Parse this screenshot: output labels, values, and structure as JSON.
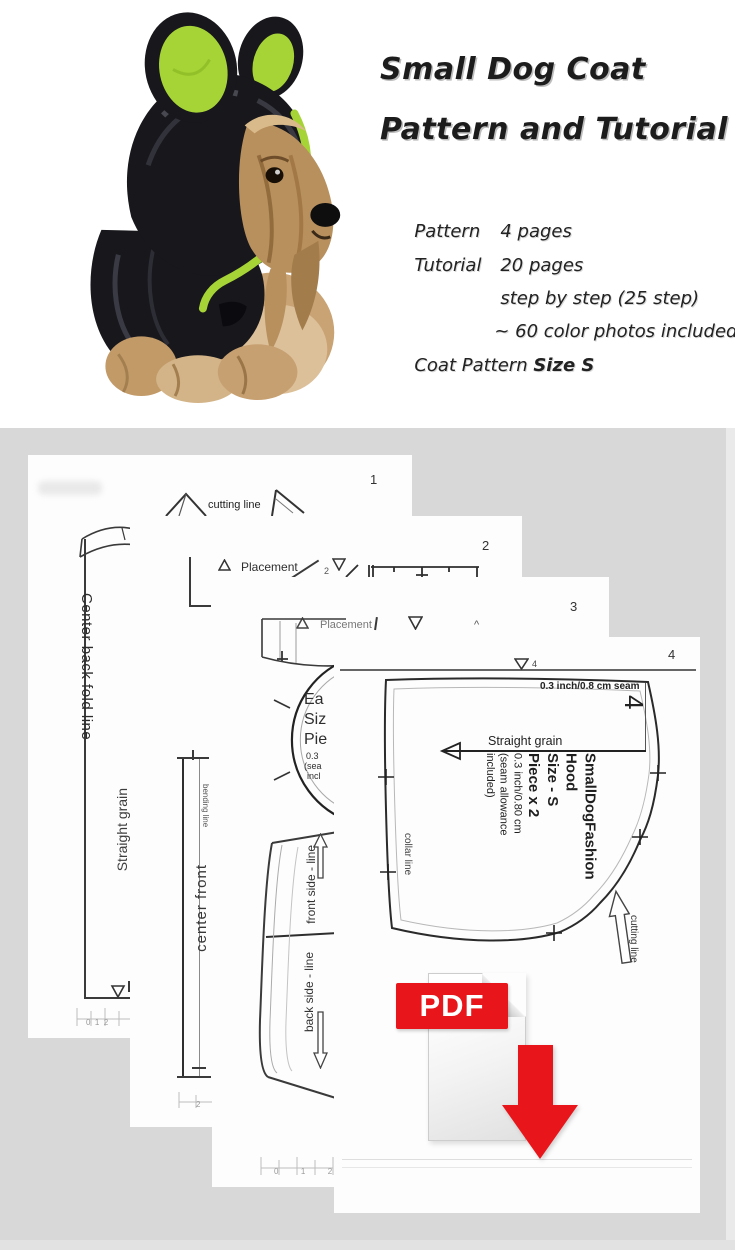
{
  "header": {
    "title_line1": "Small Dog Coat",
    "title_line2": "Pattern and Tutorial",
    "specs": [
      {
        "label": "Pattern",
        "value": "4 pages"
      },
      {
        "label": "Tutorial",
        "value": "20 pages"
      },
      {
        "label": "",
        "value": "step by step (25 step)"
      },
      {
        "label": "",
        "value": "~ 60 color photos included"
      }
    ],
    "coat_pattern_label": "Coat Pattern ",
    "coat_pattern_size": "Size S"
  },
  "p1": {
    "number": "1",
    "cutting_line": "cutting line",
    "center_back": "Center back fold line",
    "straight_grain": "Straight grain",
    "ruler": "0  1  2"
  },
  "p2": {
    "number": "2",
    "placement": "Placement",
    "placement_num": "2",
    "bending_line": "bending line",
    "center_front": "center front",
    "ruler": "2"
  },
  "p3": {
    "number": "3",
    "placement": "Placement",
    "caret": "^",
    "frag1": "Ea",
    "frag2": "Siz",
    "frag3": "Pie",
    "frag4": "0.3",
    "frag5": "(sea",
    "frag6": "incl",
    "front_side": "front side - line",
    "back_side": "back side - line",
    "ruler": "0  1  2"
  },
  "p4": {
    "number": "4",
    "marker_num": "4",
    "seam_note": "0.3 inch/0.8 cm seam",
    "big_num": "4",
    "straight_grain": "Straight grain",
    "info1": "SmallDogFashion",
    "info2": "Hood",
    "info3": "Size - S",
    "info4": "Piece x 2",
    "info5": "0.3 inch/0.80 cm",
    "info6": "(seam allowance",
    "info7": "included)",
    "collar_line": "collar line",
    "cutting_line": "cutting line"
  },
  "pdf": {
    "label": "PDF"
  },
  "colors": {
    "background_gray": "#d8d8d8",
    "accent_red": "#e8161a",
    "ear_green": "#a6d436",
    "coat_black": "#17171c"
  }
}
